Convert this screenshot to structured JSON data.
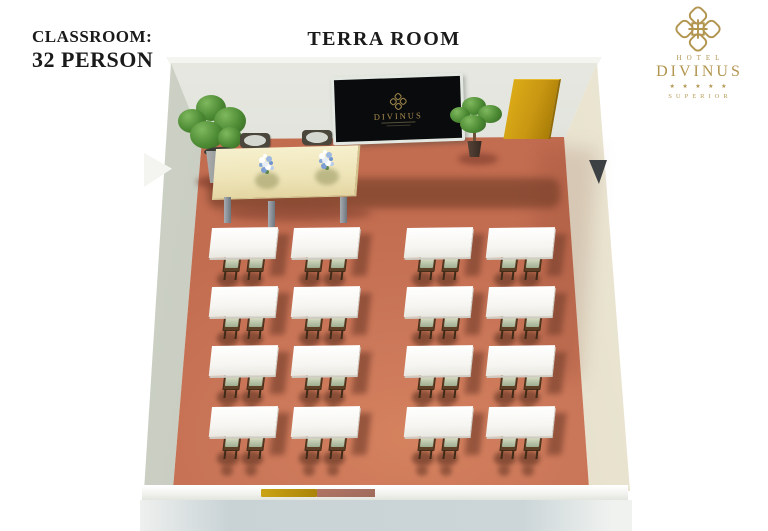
{
  "header": {
    "layout_label": "CLASSROOM:",
    "capacity_label": "32 PERSON",
    "room_title": "TERRA ROOM"
  },
  "logo": {
    "hotel_word": "HOTEL",
    "brand": "DIVINUS",
    "stars": "★ ★ ★ ★ ★",
    "tier": "SUPERIOR",
    "gold_color": "#b2954f"
  },
  "room": {
    "screen_brand": "DIVINUS",
    "layout": {
      "type": "classroom",
      "capacity_persons": 32,
      "table_rows": 4,
      "table_columns": 4,
      "tables_total": 16,
      "chairs_per_table": 2,
      "aisle": "center"
    },
    "colors": {
      "floor": "#c77257",
      "door": "#c99712",
      "walls": "#d9dcd3",
      "table_tops": "#ffffff",
      "chair_seats": "#b7c3a9",
      "head_table": "#eee4b8"
    }
  }
}
